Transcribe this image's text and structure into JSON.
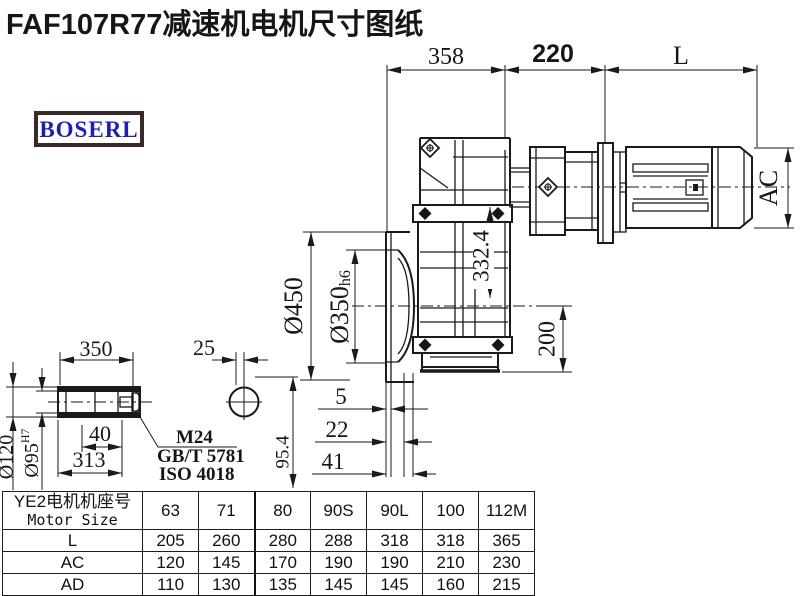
{
  "title": "FAF107R77减速机电机尺寸图纸",
  "logo": {
    "text": "BOSERL"
  },
  "drawing": {
    "dims": {
      "d358": "358",
      "d220": "220",
      "dL": "L",
      "dAC": "AC",
      "d450": "Ø450",
      "d350": "Ø350",
      "d350tol": "h6",
      "d332": "332.4",
      "d200": "200",
      "d5": "5",
      "d22": "22",
      "d41": "41",
      "len350": "350",
      "key25": "25",
      "hub": "Ø120",
      "bore": "Ø95",
      "boretol": "H7",
      "d40": "40",
      "d313": "313",
      "thread": "M24",
      "std1": "GB/T 5781",
      "std2": "ISO 4018",
      "d954": "95.4"
    }
  },
  "table": {
    "header_cn": "YE2电机机座号",
    "header_en": "Motor Size",
    "sizes": [
      "63",
      "71",
      "80",
      "90S",
      "90L",
      "100",
      "112M"
    ],
    "rows": [
      {
        "label": "L",
        "values": [
          "205",
          "260",
          "280",
          "288",
          "318",
          "318",
          "365"
        ]
      },
      {
        "label": "AC",
        "values": [
          "120",
          "145",
          "170",
          "190",
          "190",
          "210",
          "230"
        ]
      },
      {
        "label": "AD",
        "values": [
          "110",
          "130",
          "135",
          "145",
          "145",
          "160",
          "215"
        ]
      }
    ]
  },
  "colors": {
    "line": "#1a1a1a",
    "logo_text": "#1c1cbc",
    "logo_border": "#3b2827"
  }
}
